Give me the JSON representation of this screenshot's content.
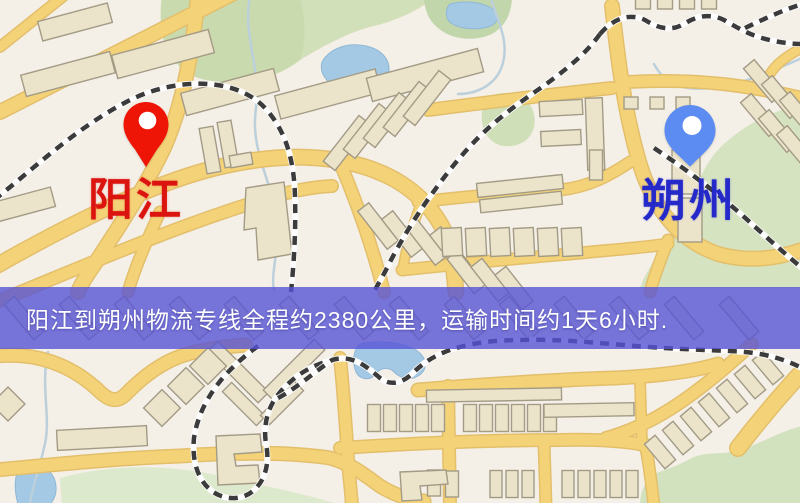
{
  "map": {
    "origin": {
      "label": "阳江",
      "pin_color": "#ee1507",
      "label_color": "#dc1410"
    },
    "destination": {
      "label": "朔州",
      "pin_color": "#5c8bf2",
      "label_color": "#2529c9"
    }
  },
  "banner": {
    "text": "阳江到朔州物流专线全程约2380公里，运输时间约1天6小时.",
    "bg_color": "#5654d6",
    "bg_opacity": 0.8,
    "text_color": "#ffffff"
  },
  "palette": {
    "map_background": "#f4efe7",
    "road": "#f4d378",
    "road_casing": "#e3bf6b",
    "railway_dash": "#3b3b3b",
    "water": "#a4c9e4",
    "park": "#cddcb2",
    "building": "#ece4ca"
  }
}
